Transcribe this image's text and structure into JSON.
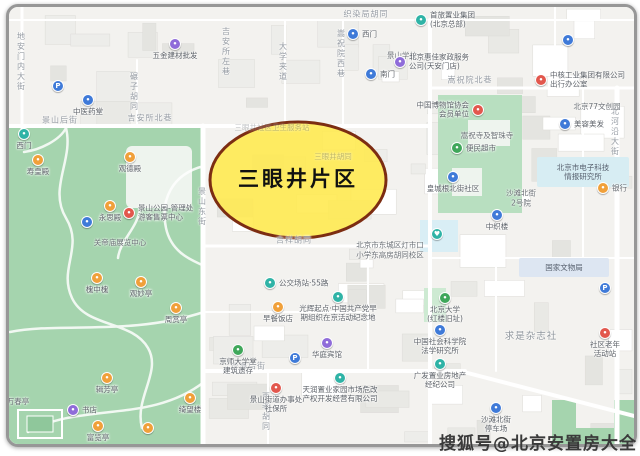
{
  "watermark": "搜狐号@北京安置房大全",
  "highlight": {
    "label": "三眼井片区",
    "fill": "#ffe94d",
    "stroke": "#7c2d12"
  },
  "palette": {
    "blue": "#3f7ad8",
    "teal": "#2fb3a6",
    "orange": "#f0a03a",
    "red": "#e2574d",
    "purple": "#8f6cd9",
    "green": "#3fa75a"
  },
  "map_colors": {
    "background": "#f3f2ef",
    "park_green": "#a5d4ae",
    "road": "#ffffff",
    "water_box": "#d9eef5"
  },
  "streets": [
    {
      "t": "地安门内大街",
      "x": 21,
      "y": 62,
      "v": 1
    },
    {
      "t": "景山后街",
      "x": 60,
      "y": 120
    },
    {
      "t": "吉安所北巷",
      "x": 150,
      "y": 118
    },
    {
      "t": "碾子胡同",
      "x": 134,
      "y": 92,
      "v": 1
    },
    {
      "t": "吉安所左巷",
      "x": 226,
      "y": 52,
      "v": 1
    },
    {
      "t": "大学夹道",
      "x": 283,
      "y": 62,
      "v": 1
    },
    {
      "t": "嵩祝院西巷",
      "x": 341,
      "y": 54,
      "v": 1
    },
    {
      "t": "织染局胡同",
      "x": 366,
      "y": 14
    },
    {
      "t": "嵩祝院北巷",
      "x": 470,
      "y": 80
    },
    {
      "t": "北河沿大街",
      "x": 615,
      "y": 132,
      "v": 1
    },
    {
      "t": "景山东街",
      "x": 202,
      "y": 207,
      "v": 1
    },
    {
      "t": "吉祥胡同",
      "x": 294,
      "y": 240
    },
    {
      "t": "沙滩后街",
      "x": 248,
      "y": 366
    },
    {
      "t": "西老胡同",
      "x": 266,
      "y": 412,
      "v": 1
    }
  ],
  "pois": [
    {
      "t": "",
      "x": 58,
      "y": 86,
      "c": "blue",
      "g": "P"
    },
    {
      "t": "五金建材批发",
      "x": 175,
      "y": 44,
      "c": "purple"
    },
    {
      "t": "中医药堂",
      "x": 88,
      "y": 100,
      "c": "blue"
    },
    {
      "t": "西门",
      "x": 24,
      "y": 134,
      "c": "teal"
    },
    {
      "t": "寿皇殿",
      "x": 38,
      "y": 160,
      "c": "orange"
    },
    {
      "t": "观德殿",
      "x": 130,
      "y": 157,
      "c": "orange"
    },
    {
      "t": "永思殿",
      "x": 110,
      "y": 206,
      "c": "orange"
    },
    {
      "t": "景山公园-管理处\n游客售票中心",
      "x": 129,
      "y": 213,
      "c": "red",
      "lp": "r"
    },
    {
      "t": "",
      "x": 87,
      "y": 222,
      "c": "blue"
    },
    {
      "t": "槐中槐",
      "x": 97,
      "y": 278,
      "c": "orange"
    },
    {
      "t": "观妙亭",
      "x": 141,
      "y": 282,
      "c": "orange"
    },
    {
      "t": "周赏亭",
      "x": 176,
      "y": 308,
      "c": "orange"
    },
    {
      "t": "辑芳亭",
      "x": 107,
      "y": 378,
      "c": "orange"
    },
    {
      "t": "书店",
      "x": 73,
      "y": 410,
      "c": "purple",
      "lp": "r"
    },
    {
      "t": "富览亭",
      "x": 98,
      "y": 426,
      "c": "orange"
    },
    {
      "t": "绮望楼",
      "x": 190,
      "y": 398,
      "c": "orange"
    },
    {
      "t": "",
      "x": 148,
      "y": 428,
      "c": "orange"
    },
    {
      "t": "西门",
      "x": 353,
      "y": 34,
      "c": "blue",
      "lp": "r"
    },
    {
      "t": "南门",
      "x": 371,
      "y": 74,
      "c": "blue",
      "lp": "r"
    },
    {
      "t": "北京惠佳家政服务\n公司(天安门店)",
      "x": 400,
      "y": 62,
      "c": "purple",
      "lp": "r"
    },
    {
      "t": "首旅置业集团\n(北京总部)",
      "x": 421,
      "y": 20,
      "c": "teal",
      "lp": "r"
    },
    {
      "t": "",
      "x": 568,
      "y": 40,
      "c": "blue"
    },
    {
      "t": "中国博物馆协会\n会员单位",
      "x": 478,
      "y": 110,
      "c": "red",
      "lp": "l"
    },
    {
      "t": "便民超市",
      "x": 457,
      "y": 148,
      "c": "green",
      "lp": "r"
    },
    {
      "t": "美容美发",
      "x": 565,
      "y": 124,
      "c": "blue",
      "lp": "r"
    },
    {
      "t": "皇城根北街社区",
      "x": 453,
      "y": 177,
      "c": "blue"
    },
    {
      "t": "中核工业集团有限公司\n出行办公室",
      "x": 541,
      "y": 80,
      "c": "red",
      "lp": "r"
    },
    {
      "t": "银行",
      "x": 603,
      "y": 188,
      "c": "orange",
      "lp": "r"
    },
    {
      "t": "中织楼",
      "x": 497,
      "y": 215,
      "c": "blue"
    },
    {
      "t": "",
      "x": 437,
      "y": 234,
      "c": "teal",
      "g": "♥"
    },
    {
      "t": "公交场站·55路",
      "x": 270,
      "y": 283,
      "c": "teal",
      "lp": "r"
    },
    {
      "t": "早餐饭店",
      "x": 278,
      "y": 307,
      "c": "orange"
    },
    {
      "t": "光辉起点·中国共产党早\n期组织在京活动纪念地",
      "x": 338,
      "y": 297,
      "c": "teal"
    },
    {
      "t": "华庭宾馆",
      "x": 327,
      "y": 343,
      "c": "purple"
    },
    {
      "t": "京师大学堂\n建筑遗存",
      "x": 238,
      "y": 350,
      "c": "green"
    },
    {
      "t": "",
      "x": 295,
      "y": 358,
      "c": "blue",
      "g": "P"
    },
    {
      "t": "景山街道办事处\n社保所",
      "x": 276,
      "y": 388,
      "c": "red"
    },
    {
      "t": "天润置业家园市场危改\n产权开发经营有限公司",
      "x": 340,
      "y": 378,
      "c": "teal"
    },
    {
      "t": "广发置业房地产\n经纪公司",
      "x": 440,
      "y": 364,
      "c": "teal"
    },
    {
      "t": "北京大学\n(红楼旧址)",
      "x": 445,
      "y": 298,
      "c": "green"
    },
    {
      "t": "中国社会科学院\n法学研究所",
      "x": 440,
      "y": 330,
      "c": "blue"
    },
    {
      "t": "沙滩北街\n停车场",
      "x": 496,
      "y": 408,
      "c": "blue"
    },
    {
      "t": "社区老年\n活动站",
      "x": 605,
      "y": 333,
      "c": "red"
    },
    {
      "t": "",
      "x": 605,
      "y": 288,
      "c": "blue",
      "g": "P"
    }
  ],
  "labels": [
    {
      "t": "三眼井社区卫生服务站",
      "x": 272,
      "y": 128,
      "faint": 1
    },
    {
      "t": "三眼井胡同",
      "x": 333,
      "y": 157,
      "faint": 1
    },
    {
      "t": "嵩祝寺及智珠寺",
      "x": 487,
      "y": 136
    },
    {
      "t": "北京77文创园",
      "x": 597,
      "y": 107
    },
    {
      "t": "沙滩北街\n2号院",
      "x": 521,
      "y": 198
    },
    {
      "t": "求是杂志社",
      "x": 531,
      "y": 337,
      "big": 1
    },
    {
      "t": "万春亭",
      "x": 18,
      "y": 402
    },
    {
      "t": "关帝庙展览中心",
      "x": 120,
      "y": 243
    },
    {
      "t": "北京市东城区灯市口\n小学东高房胡同校区",
      "x": 390,
      "y": 250
    },
    {
      "t": "景山学校",
      "x": 402,
      "y": 56
    }
  ],
  "zones": [
    {
      "t": "国家文物局",
      "x": 519,
      "y": 258,
      "w": 90,
      "h": 19,
      "bg": "#dde6f2"
    },
    {
      "t": "北京市电子科技\n情报研究所",
      "x": 537,
      "y": 157,
      "w": 92,
      "h": 30,
      "bg": "#d7edf3"
    }
  ]
}
